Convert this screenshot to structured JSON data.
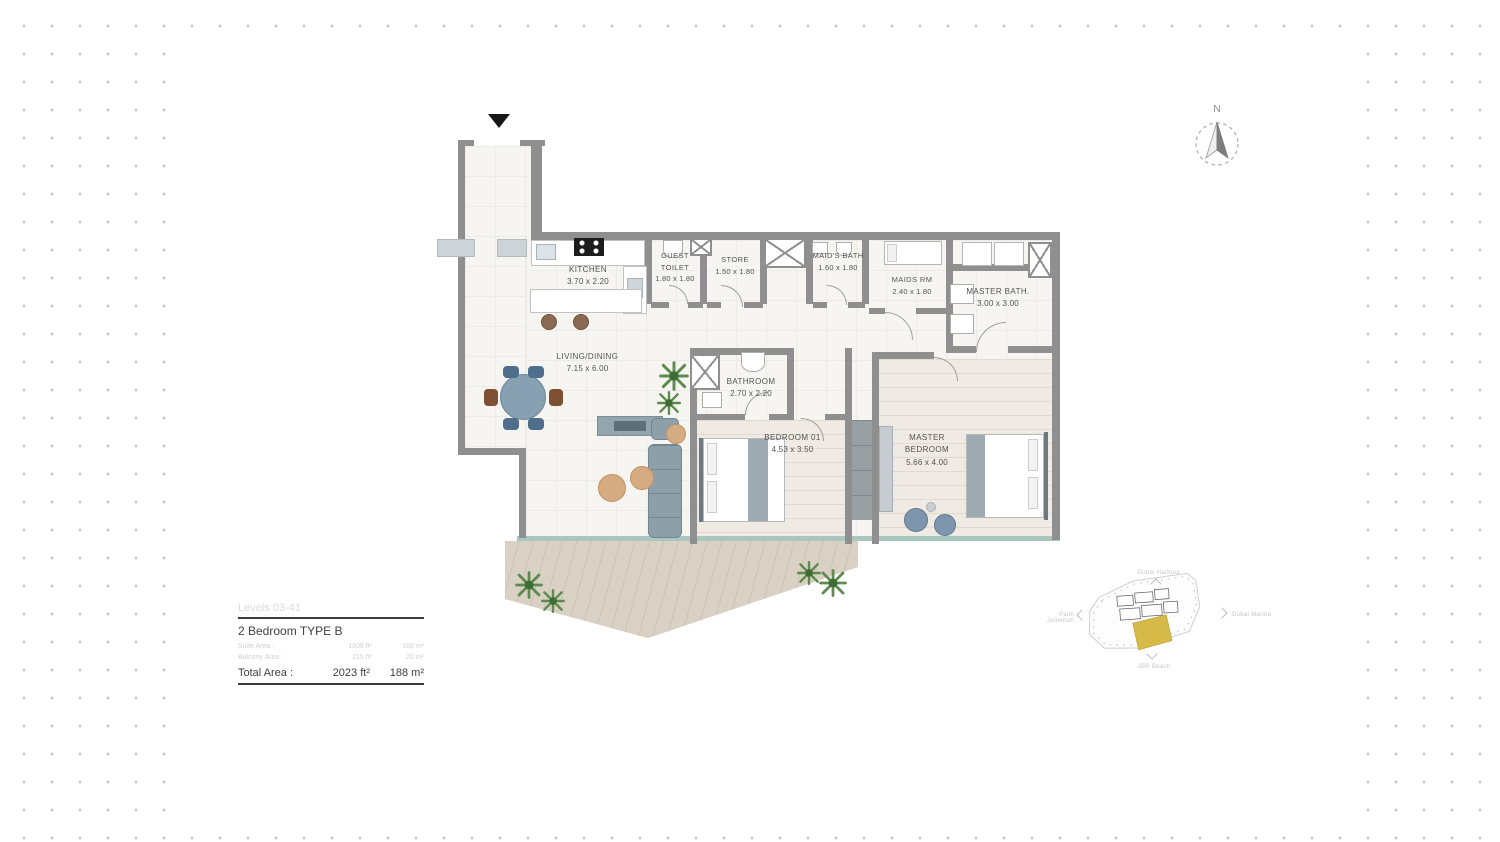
{
  "floor_plan": {
    "rooms": [
      {
        "id": "kitchen",
        "name": "KITCHEN",
        "dims": "3.70 x 2.20"
      },
      {
        "id": "guest-toilet",
        "name": "GUEST TOILET",
        "dims": "1.80 x 1.80"
      },
      {
        "id": "store",
        "name": "STORE",
        "dims": "1.50 x 1.80"
      },
      {
        "id": "maids-bath",
        "name": "MAID'S BATH",
        "dims": "1.60 x 1.80"
      },
      {
        "id": "maids-rm",
        "name": "MAIDS RM",
        "dims": "2.40 x 1.80"
      },
      {
        "id": "master-bath",
        "name": "MASTER BATH.",
        "dims": "3.00 x 3.00"
      },
      {
        "id": "living-dining",
        "name": "LIVING/DINING",
        "dims": "7.15 x 6.00"
      },
      {
        "id": "bathroom",
        "name": "BATHROOM",
        "dims": "2.70 x 2.20"
      },
      {
        "id": "bedroom-01",
        "name": "BEDROOM 01",
        "dims": "4.53 x 3.50"
      },
      {
        "id": "master-bedroom",
        "name": "MASTER BEDROOM",
        "dims": "5.66 x 4.00"
      }
    ]
  },
  "info_box": {
    "levels": "Levels 03-41",
    "unit_type": "2 Bedroom  TYPE B",
    "rows": [
      {
        "label": "Suite Area :",
        "ft": "1808 ft²",
        "m": "168 m²"
      },
      {
        "label": "Balcony Area :",
        "ft": "215 ft²",
        "m": "20 m²"
      }
    ],
    "total_label": "Total Area :",
    "total_ft": "2023 ft²",
    "total_m": "188 m²"
  },
  "compass": {
    "north_label": "N"
  },
  "locator": {
    "top": "Dubai Harbour",
    "left": "Palm Jumeirah",
    "right": "Dubai Marina",
    "bottom": "JBR Beach",
    "highlight_color": "#d6ba49"
  }
}
